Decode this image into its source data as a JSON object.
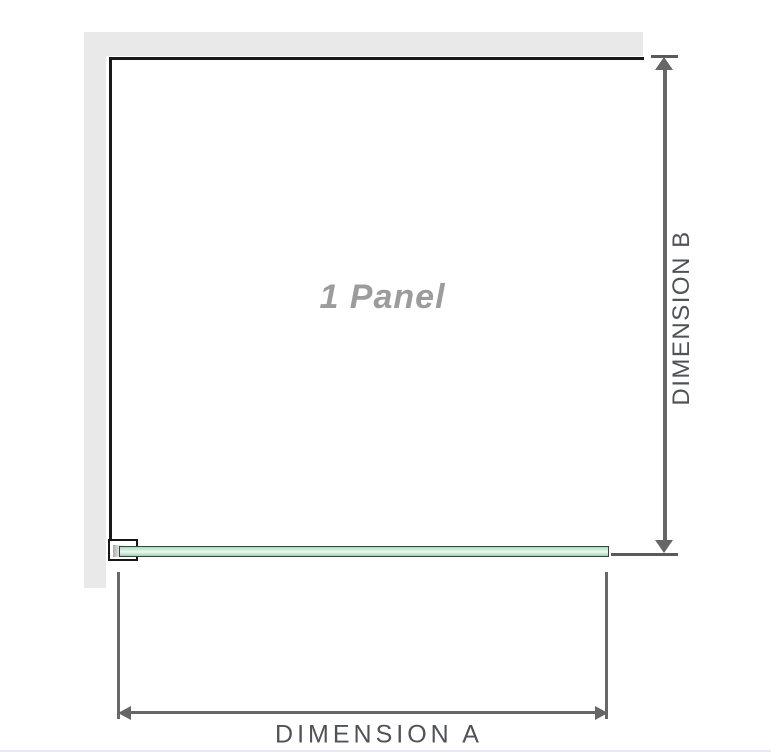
{
  "diagram": {
    "type": "product-dimension-diagram",
    "panel_label": "1 Panel",
    "dimension_a_label": "DIMENSION A",
    "dimension_b_label": "DIMENSION B"
  },
  "colors": {
    "background": "#ffffff",
    "wall_fill": "#e9e9e9",
    "panel_outline": "#1a1a1a",
    "dimension_lines": "#666666",
    "dimension_label_text": "#4f5357",
    "panel_label_text": "#9c9c9c",
    "glass_border": "#3a443c",
    "glass_fill_light": "#f2faf5",
    "glass_fill_green": "#a6dcb8",
    "clamp_outline": "#161616",
    "clamp_slot": "#a9acad",
    "bottom_rule": "#e7e8f0"
  }
}
